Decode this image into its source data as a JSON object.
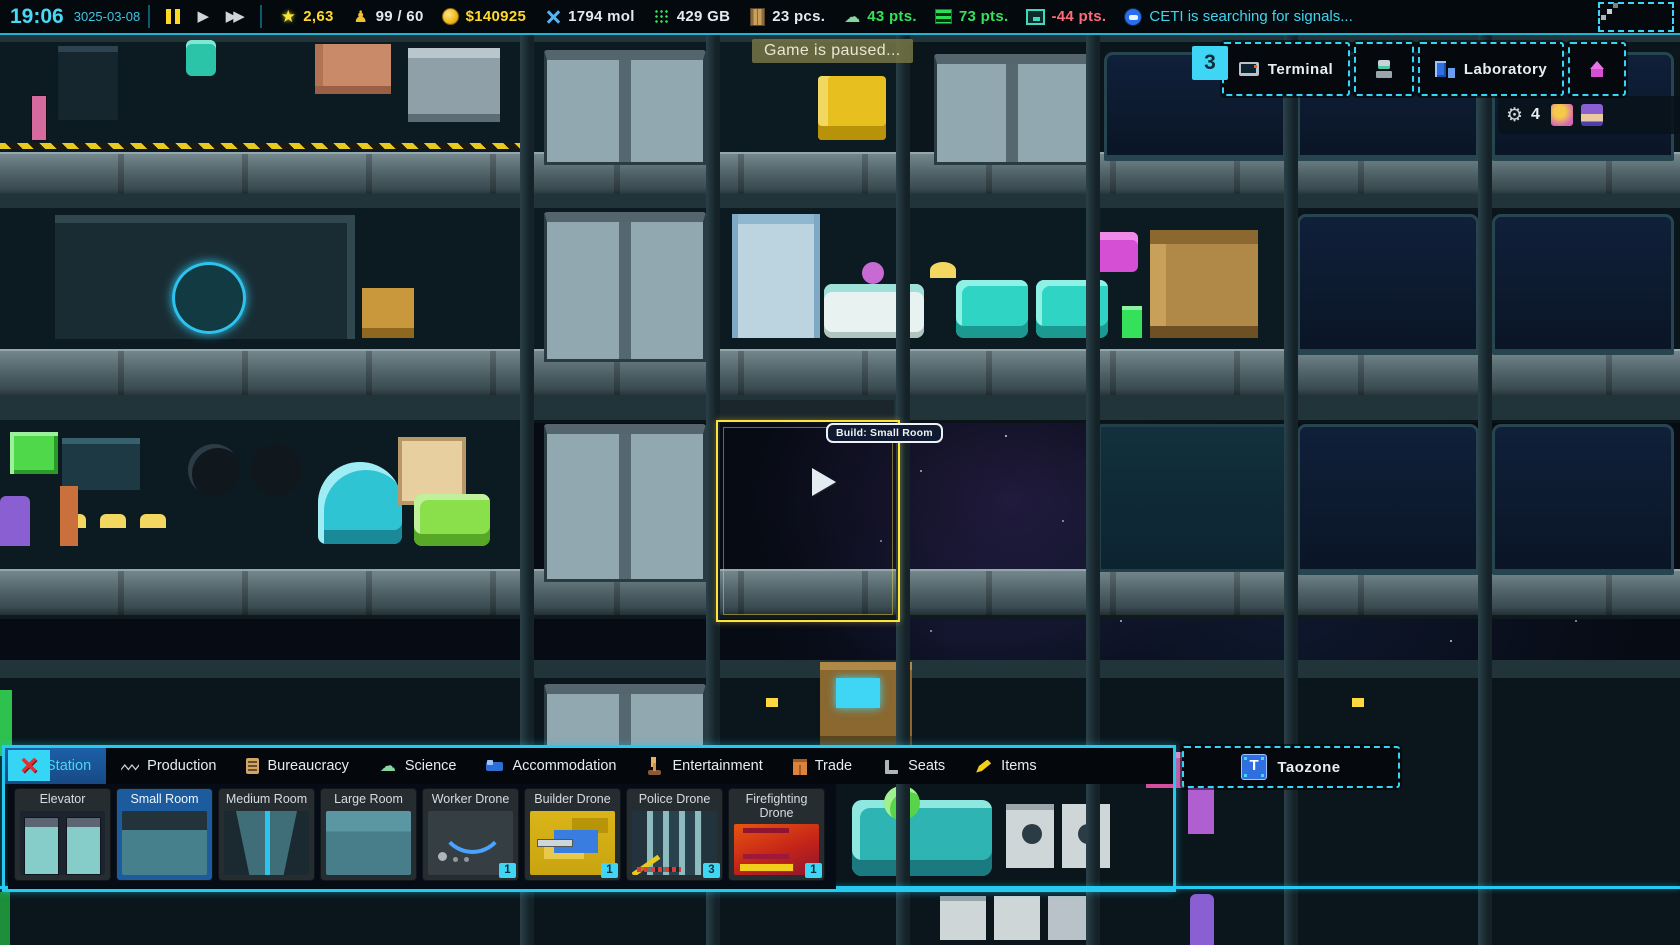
{
  "colors": {
    "accent": "#26c9f0",
    "selected_blue": "#1d5b9f",
    "yellow": "#ffd82e",
    "green": "#35e05a",
    "red": "#ff6b7a",
    "gold": "#f5c518",
    "ghost_yellow": "#ffe23c"
  },
  "icons": {
    "star-icon": "★",
    "statue-icon": "♟",
    "play-icon": "▶",
    "fast-forward-icon": "▶▶",
    "gear-icon": "⚙",
    "close-icon": "×",
    "brain-icon": "☁"
  },
  "top_bar": {
    "time": "19:06",
    "date": "3025-03-08",
    "resources": [
      {
        "name": "station-rating",
        "icon": "star-icon",
        "value": "2,63"
      },
      {
        "name": "crew-capacity",
        "icon": "statue-icon",
        "value": "99 / 60"
      },
      {
        "name": "credits",
        "icon": "coin-icon",
        "value": "$140925"
      },
      {
        "name": "molecules",
        "icon": "molecule-icon",
        "value": "1794 mol"
      },
      {
        "name": "data-storage",
        "icon": "data-grid-icon",
        "value": "429 GB"
      },
      {
        "name": "parts",
        "icon": "crate-icon",
        "value": "23 pcs."
      },
      {
        "name": "research-points",
        "icon": "brain-icon",
        "value": "43 pts."
      },
      {
        "name": "production-points",
        "icon": "server-icon",
        "value": "73 pts."
      },
      {
        "name": "comfort-points",
        "icon": "room-icon",
        "value": "-44 pts."
      }
    ],
    "status_message": "CETI is searching for signals..."
  },
  "hud": {
    "paused_banner": "Game is paused...",
    "terminal": {
      "badge": "3",
      "label": "Terminal"
    },
    "laboratory": {
      "label": "Laboratory"
    },
    "crew_panel": {
      "count": "4"
    }
  },
  "build_cursor": {
    "tooltip": "Build: Small Room"
  },
  "build_menu": {
    "tabs": [
      {
        "label": "Station",
        "icon": "pipe-icon",
        "selected": true
      },
      {
        "label": "Production",
        "icon": "wave-icon",
        "selected": false
      },
      {
        "label": "Bureaucracy",
        "icon": "clipboard-icon",
        "selected": false
      },
      {
        "label": "Science",
        "icon": "brain-icon",
        "selected": false
      },
      {
        "label": "Accommodation",
        "icon": "bed-icon",
        "selected": false
      },
      {
        "label": "Entertainment",
        "icon": "joystick-icon",
        "selected": false
      },
      {
        "label": "Trade",
        "icon": "crate-icon",
        "selected": false
      },
      {
        "label": "Seats",
        "icon": "chair-icon",
        "selected": false
      },
      {
        "label": "Items",
        "icon": "pencil-icon",
        "selected": false
      }
    ],
    "taozone_label": "Taozone",
    "items": [
      {
        "label": "Elevator",
        "selected": false
      },
      {
        "label": "Small Room",
        "selected": true
      },
      {
        "label": "Medium Room",
        "selected": false
      },
      {
        "label": "Large Room",
        "selected": false
      },
      {
        "label": "Worker Drone",
        "selected": false,
        "count": "1"
      },
      {
        "label": "Builder Drone",
        "selected": false,
        "count": "1"
      },
      {
        "label": "Police Drone",
        "selected": false,
        "count": "3"
      },
      {
        "label": "Firefighting Drone",
        "selected": false,
        "count": "1"
      }
    ]
  }
}
